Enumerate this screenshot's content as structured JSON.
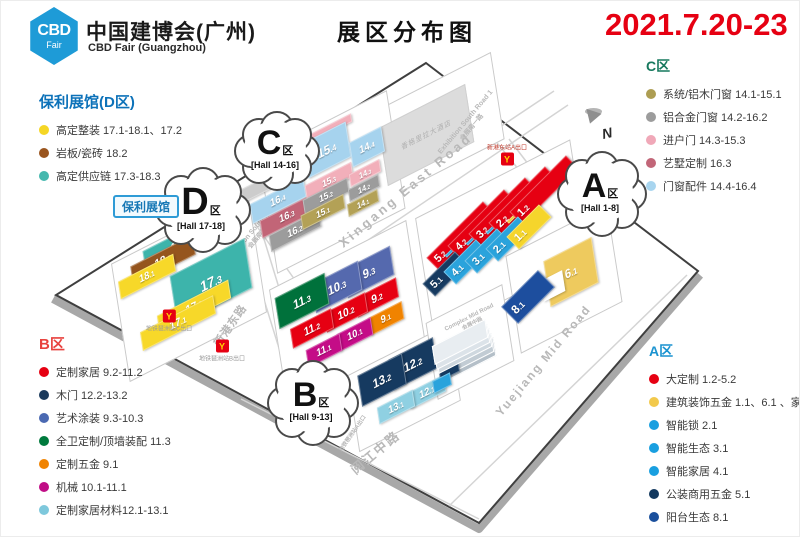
{
  "header": {
    "logo_line1": "CBD",
    "logo_line2": "Fair",
    "title_cn": "中国建博会(广州)",
    "title_en": "CBD Fair (Guangzhou)",
    "page_title": "展区分布图",
    "date": "2021.7.20-23",
    "date_color": "#e60012"
  },
  "legends": [
    {
      "id": "d",
      "title": "保利展馆(D区)",
      "color": "#0d72b9",
      "items": [
        {
          "dot": "#f5d625",
          "label": "高定整装 17.1-18.1、17.2"
        },
        {
          "dot": "#9a551e",
          "label": "岩板/瓷砖 18.2"
        },
        {
          "dot": "#45b8ae",
          "label": "高定供应链 17.3-18.3"
        }
      ]
    },
    {
      "id": "b",
      "title": "B区",
      "color": "#e8433f",
      "items": [
        {
          "dot": "#e60012",
          "label": "定制家居 9.2-11.2"
        },
        {
          "dot": "#1b3a5c",
          "label": "木门 12.2-13.2"
        },
        {
          "dot": "#4a69b2",
          "label": "艺术涂装 9.3-10.3"
        },
        {
          "dot": "#007a3d",
          "label": "全卫定制/顶墙装配 11.3"
        },
        {
          "dot": "#f08300",
          "label": "定制五金 9.1"
        },
        {
          "dot": "#c00d86",
          "label": "机械 10.1-11.1"
        },
        {
          "dot": "#7ec8dc",
          "label": "定制家居材料12.1-13.1"
        }
      ]
    },
    {
      "id": "c",
      "title": "C区",
      "color": "#17795e",
      "items": [
        {
          "dot": "#ad9d52",
          "label": "系统/铝木门窗 14.1-15.1"
        },
        {
          "dot": "#9c9c9c",
          "label": "铝合金门窗 14.2-16.2"
        },
        {
          "dot": "#f0a8b8",
          "label": "进户门 14.3-15.3"
        },
        {
          "dot": "#c26678",
          "label": "艺墅定制 16.3"
        },
        {
          "dot": "#a8d5ef",
          "label": "门窗配件 14.4-16.4"
        }
      ]
    },
    {
      "id": "a",
      "title": "A区",
      "color": "#1b93d0",
      "items": [
        {
          "dot": "#e60012",
          "label": "大定制 1.2-5.2"
        },
        {
          "dot": "#f2c94c",
          "label": "建筑装饰五金 1.1、6.1 、家居精品廊"
        },
        {
          "dot": "#199fe0",
          "label": "智能锁 2.1"
        },
        {
          "dot": "#199fe0",
          "label": "智能生态 3.1"
        },
        {
          "dot": "#199fe0",
          "label": "智能家居 4.1"
        },
        {
          "dot": "#12385e",
          "label": "公装商用五金 5.1"
        },
        {
          "dot": "#1a4f9c",
          "label": "阳台生态 8.1"
        }
      ]
    }
  ],
  "map": {
    "badge": "保利展馆",
    "zone_char": "区",
    "compass": "N",
    "hotel": {
      "label": "香格里拉大酒店",
      "x": 424,
      "y": 133,
      "w": 95,
      "h": 54
    },
    "clouds": [
      {
        "letter": "C",
        "hall": "[Hall 14-16]",
        "x": 274,
        "y": 148,
        "w": 82,
        "h": 72,
        "lfs": 34
      },
      {
        "letter": "D",
        "hall": "[Hall 17-18]",
        "x": 200,
        "y": 207,
        "w": 92,
        "h": 78,
        "lfs": 38
      },
      {
        "letter": "A",
        "hall": "[Hall 1-8]",
        "x": 599,
        "y": 191,
        "w": 86,
        "h": 78,
        "lfs": 34
      },
      {
        "letter": "B",
        "hall": "[Hall 9-13]",
        "x": 310,
        "y": 400,
        "w": 88,
        "h": 78,
        "lfs": 34
      }
    ],
    "parcels": [
      {
        "x": 428,
        "y": 128,
        "w": 150,
        "h": 82
      },
      {
        "x": 330,
        "y": 180,
        "w": 142,
        "h": 112
      },
      {
        "x": 500,
        "y": 236,
        "w": 172,
        "h": 112
      },
      {
        "x": 345,
        "y": 312,
        "w": 152,
        "h": 112
      },
      {
        "x": 402,
        "y": 386,
        "w": 112,
        "h": 72
      },
      {
        "x": 187,
        "y": 286,
        "w": 152,
        "h": 112
      },
      {
        "x": 562,
        "y": 277,
        "w": 112,
        "h": 92
      },
      {
        "x": 468,
        "y": 340,
        "w": 84,
        "h": 72
      }
    ],
    "slabs": {
      "x": 466,
      "y": 358,
      "w": 58,
      "h": 16,
      "colors": [
        "#b4bfc8",
        "#c2ccd4",
        "#cfd8df",
        "#dce3e9",
        "#e8edf1"
      ]
    },
    "halls": [
      {
        "id": "18.3",
        "x": 178,
        "y": 243,
        "w": 78,
        "h": 21,
        "c": "#3db4ab",
        "fs": 11
      },
      {
        "id": "18.2",
        "x": 162,
        "y": 259,
        "w": 70,
        "h": 19,
        "c": "#95551e",
        "fs": 11
      },
      {
        "id": "18.1",
        "x": 146,
        "y": 275,
        "w": 62,
        "h": 17,
        "c": "#f7d829",
        "fs": 10
      },
      {
        "id": "17.3",
        "x": 210,
        "y": 281,
        "w": 84,
        "h": 48,
        "c": "#3db4ab",
        "fs": 14
      },
      {
        "id": "17.2",
        "x": 193,
        "y": 306,
        "w": 80,
        "h": 18,
        "c": "#f7d829",
        "fs": 11
      },
      {
        "id": "17.1",
        "x": 177,
        "y": 322,
        "w": 82,
        "h": 18,
        "c": "#f7d829",
        "fs": 11
      },
      {
        "id": "",
        "x": 262,
        "y": 184,
        "w": 66,
        "h": 13,
        "c": "#cccccc"
      },
      {
        "id": "16.4",
        "x": 277,
        "y": 199,
        "w": 60,
        "h": 19,
        "c": "#a6d3ee",
        "fs": 10
      },
      {
        "id": "16.3",
        "x": 286,
        "y": 215,
        "w": 58,
        "h": 17,
        "c": "#c26577",
        "fs": 10
      },
      {
        "id": "16.2",
        "x": 294,
        "y": 230,
        "w": 56,
        "h": 16,
        "c": "#9c9c9c",
        "fs": 10
      },
      {
        "id": "",
        "x": 330,
        "y": 127,
        "w": 46,
        "h": 8,
        "c": "#f2afba"
      },
      {
        "id": "15.4",
        "x": 326,
        "y": 149,
        "w": 48,
        "h": 34,
        "c": "#a6d3ee",
        "fs": 12
      },
      {
        "id": "15.3",
        "x": 328,
        "y": 180,
        "w": 52,
        "h": 14,
        "c": "#f2afba",
        "fs": 9
      },
      {
        "id": "15.2",
        "x": 325,
        "y": 195,
        "w": 50,
        "h": 14,
        "c": "#9c9c9c",
        "fs": 9
      },
      {
        "id": "15.1",
        "x": 322,
        "y": 211,
        "w": 48,
        "h": 14,
        "c": "#b3a156",
        "fs": 9
      },
      {
        "id": "14.4",
        "x": 366,
        "y": 146,
        "w": 36,
        "h": 24,
        "c": "#a6d3ee",
        "fs": 10
      },
      {
        "id": "14.3",
        "x": 364,
        "y": 172,
        "w": 34,
        "h": 12,
        "c": "#f2afba",
        "fs": 8
      },
      {
        "id": "14.2",
        "x": 363,
        "y": 187,
        "w": 34,
        "h": 12,
        "c": "#9c9c9c",
        "fs": 8
      },
      {
        "id": "14.1",
        "x": 362,
        "y": 202,
        "w": 34,
        "h": 12,
        "c": "#b3a156",
        "fs": 8
      },
      {
        "id": "9.3",
        "x": 368,
        "y": 271,
        "w": 52,
        "h": 28,
        "c": "#5569ae",
        "fs": 12
      },
      {
        "id": "10.3",
        "x": 336,
        "y": 286,
        "w": 52,
        "h": 28,
        "c": "#5569ae",
        "fs": 12
      },
      {
        "id": "11.3",
        "x": 301,
        "y": 300,
        "w": 56,
        "h": 30,
        "c": "#00713b",
        "fs": 12
      },
      {
        "id": "9.2",
        "x": 376,
        "y": 296,
        "w": 46,
        "h": 19,
        "c": "#e60012",
        "fs": 11
      },
      {
        "id": "10.2",
        "x": 345,
        "y": 311,
        "w": 46,
        "h": 19,
        "c": "#e60012",
        "fs": 11
      },
      {
        "id": "11.2",
        "x": 311,
        "y": 327,
        "w": 46,
        "h": 19,
        "c": "#e60012",
        "fs": 11
      },
      {
        "id": "9.1",
        "x": 385,
        "y": 317,
        "w": 38,
        "h": 17,
        "c": "#f08300",
        "fs": 10
      },
      {
        "id": "10.1",
        "x": 354,
        "y": 333,
        "w": 38,
        "h": 17,
        "c": "#c40c87",
        "fs": 10
      },
      {
        "id": "11.1",
        "x": 323,
        "y": 349,
        "w": 38,
        "h": 17,
        "c": "#c40c87",
        "fs": 10
      },
      {
        "id": "12.2",
        "x": 412,
        "y": 363,
        "w": 50,
        "h": 30,
        "c": "#163a60",
        "fs": 12
      },
      {
        "id": "13.2",
        "x": 381,
        "y": 379,
        "w": 50,
        "h": 30,
        "c": "#163a60",
        "fs": 12
      },
      {
        "id": "12.1",
        "x": 426,
        "y": 391,
        "w": 40,
        "h": 16,
        "c": "#8fd0e2",
        "fs": 10
      },
      {
        "id": "13.1",
        "x": 395,
        "y": 406,
        "w": 40,
        "h": 16,
        "c": "#8fd0e2",
        "fs": 10
      },
      {
        "id": "5.2",
        "x": 460,
        "y": 235,
        "w": 80,
        "h": 18,
        "c": "#e60012",
        "r": -45,
        "k": 0,
        "fs": 11,
        "st": 1
      },
      {
        "id": "",
        "x": 471,
        "y": 229,
        "w": 74,
        "h": 3,
        "c": "#2aa3dc",
        "r": -45,
        "k": 0
      },
      {
        "id": "4.2",
        "x": 481,
        "y": 223,
        "w": 80,
        "h": 18,
        "c": "#e60012",
        "r": -45,
        "k": 0,
        "fs": 11,
        "st": 1
      },
      {
        "id": "",
        "x": 492,
        "y": 217,
        "w": 74,
        "h": 3,
        "c": "#2aa3dc",
        "r": -45,
        "k": 0
      },
      {
        "id": "3.2",
        "x": 502,
        "y": 211,
        "w": 80,
        "h": 18,
        "c": "#e60012",
        "r": -45,
        "k": 0,
        "fs": 11,
        "st": 1
      },
      {
        "id": "",
        "x": 512,
        "y": 206,
        "w": 74,
        "h": 3,
        "c": "#2aa3dc",
        "r": -45,
        "k": 0
      },
      {
        "id": "2.2",
        "x": 522,
        "y": 200,
        "w": 80,
        "h": 18,
        "c": "#e60012",
        "r": -45,
        "k": 0,
        "fs": 11,
        "st": 1
      },
      {
        "id": "",
        "x": 533,
        "y": 195,
        "w": 74,
        "h": 3,
        "c": "#f0c830",
        "r": -45,
        "k": 0
      },
      {
        "id": "1.2",
        "x": 543,
        "y": 189,
        "w": 80,
        "h": 18,
        "c": "#e60012",
        "r": -45,
        "k": 0,
        "fs": 11,
        "st": 1
      },
      {
        "id": "5.1",
        "x": 444,
        "y": 273,
        "w": 46,
        "h": 18,
        "c": "#163a60",
        "r": -45,
        "k": 0,
        "fs": 11,
        "st": 1
      },
      {
        "id": "4.1",
        "x": 465,
        "y": 261,
        "w": 46,
        "h": 18,
        "c": "#2aa3dc",
        "r": -45,
        "k": 0,
        "fs": 11,
        "st": 1
      },
      {
        "id": "3.1",
        "x": 486,
        "y": 250,
        "w": 46,
        "h": 18,
        "c": "#2aa3dc",
        "r": -45,
        "k": 0,
        "fs": 11,
        "st": 1
      },
      {
        "id": "2.1",
        "x": 507,
        "y": 238,
        "w": 46,
        "h": 18,
        "c": "#2aa3dc",
        "r": -45,
        "k": 0,
        "fs": 11,
        "st": 1
      },
      {
        "id": "1.1",
        "x": 528,
        "y": 226,
        "w": 46,
        "h": 18,
        "c": "#f5d52c",
        "r": -45,
        "k": 0,
        "fs": 11,
        "st": 1
      },
      {
        "id": "6.1",
        "x": 570,
        "y": 271,
        "w": 54,
        "h": 44,
        "c": "#eeca5e",
        "fs": 12
      },
      {
        "id": "",
        "x": 552,
        "y": 285,
        "w": 24,
        "h": 20,
        "c": "#ffffff"
      },
      {
        "id": "8.1",
        "x": 527,
        "y": 296,
        "w": 52,
        "h": 24,
        "c": "#1d4e9e",
        "r": -45,
        "k": 0,
        "fs": 12,
        "st": 1
      },
      {
        "id": "",
        "x": 448,
        "y": 368,
        "w": 22,
        "h": 14,
        "c": "#163a60"
      },
      {
        "id": "",
        "x": 441,
        "y": 382,
        "w": 20,
        "h": 12,
        "c": "#2aa3dc"
      }
    ],
    "roads": [
      {
        "en": "Xingang East Road",
        "x": 405,
        "y": 190,
        "r": -40,
        "fs": 13,
        "ls": 3
      },
      {
        "cn": "新港东路",
        "x": 230,
        "y": 325,
        "r": -55,
        "fs": 12,
        "ls": 1
      },
      {
        "cn": "阅江中路",
        "x": 375,
        "y": 452,
        "r": -40,
        "fs": 14,
        "ls": 2
      },
      {
        "en": "Yuejiang Mid Road",
        "x": 543,
        "y": 360,
        "r": -50,
        "fs": 12,
        "ls": 2
      },
      {
        "en": "Exhibition South Road 1",
        "cn": "会展南一路",
        "x": 468,
        "y": 124,
        "r": -50,
        "fs": 7
      },
      {
        "en": "Exhibition South Road 3",
        "cn": "会展南三路",
        "x": 256,
        "y": 232,
        "r": -50,
        "fs": 7
      },
      {
        "en": "Complex West Road",
        "x": 533,
        "y": 200,
        "r": -50,
        "fs": 7
      },
      {
        "en": "Complex Mid Road",
        "cn": "会展中路",
        "x": 470,
        "y": 320,
        "r": -27,
        "fs": 6
      },
      {
        "cn": "地铁琶洲站A出口",
        "x": 352,
        "y": 433,
        "r": -55,
        "fs": 6
      }
    ],
    "metro": [
      {
        "label": "地铁琶洲站C出口",
        "x": 168,
        "y": 320,
        "lp": "b"
      },
      {
        "label": "地铁琶洲站B出口",
        "x": 221,
        "y": 350,
        "lp": "b"
      },
      {
        "label": "新港东站A出口",
        "x": 506,
        "y": 153,
        "lp": "a"
      }
    ]
  }
}
